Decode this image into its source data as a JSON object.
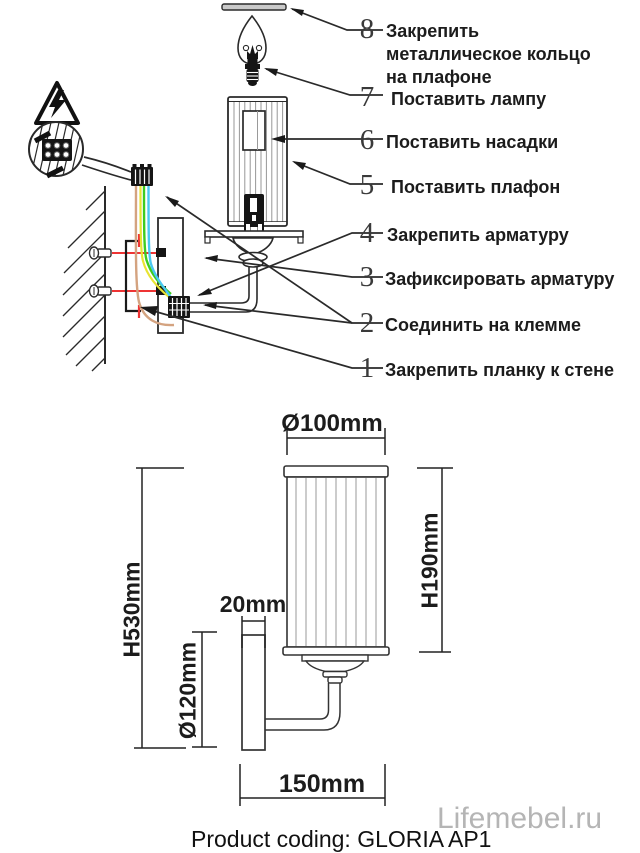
{
  "steps": [
    {
      "num": "8",
      "label": "Закрепить металлическое кольцо на плафоне"
    },
    {
      "num": "7",
      "label": "Поставить лампу"
    },
    {
      "num": "6",
      "label": "Поставить насадки"
    },
    {
      "num": "5",
      "label": "Поставить плафон"
    },
    {
      "num": "4",
      "label": "Закрепить арматуру"
    },
    {
      "num": "3",
      "label": "Зафиксировать арматуру"
    },
    {
      "num": "2",
      "label": "Соединить на клемме"
    },
    {
      "num": "1",
      "label": "Закрепить планку к стене"
    }
  ],
  "dimensions": {
    "shade_diameter": "Ø100mm",
    "shade_height": "H190mm",
    "total_height": "H530mm",
    "backplate_diameter": "Ø120mm",
    "bracket_depth": "20mm",
    "arm_projection": "150mm"
  },
  "footer": {
    "product_coding": "Product coding: GLORIA AP1",
    "watermark": "Lifemebel.ru"
  },
  "colors": {
    "line": "#2a2a2a",
    "wire_brown": "#d4a380",
    "wire_yellow": "#e8e432",
    "wire_green": "#3fcc1f",
    "wire_blue": "#49c8f2",
    "screw_mark_red": "#ee3434",
    "watermark_gray": "#b5b5b5"
  }
}
